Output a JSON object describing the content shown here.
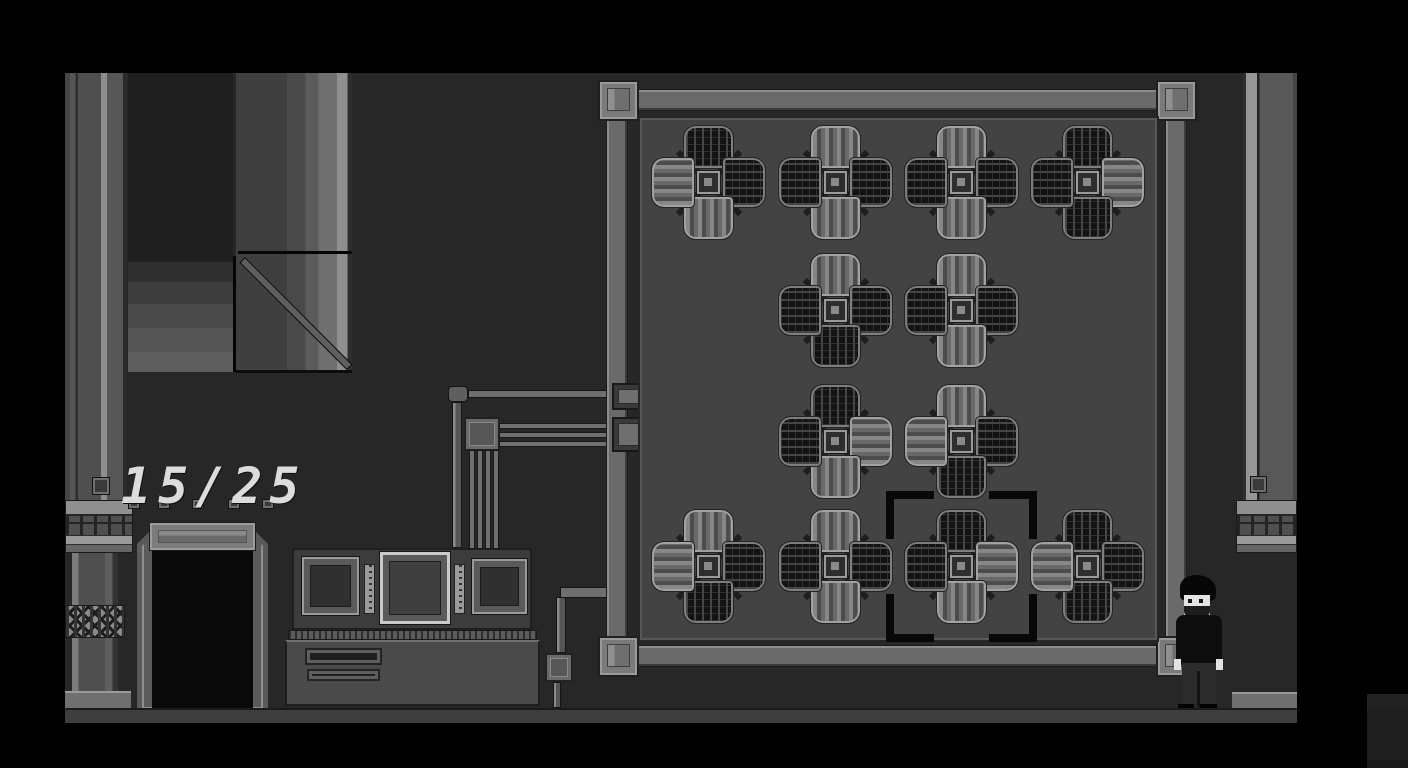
{
  "hud": {
    "counter": "15/25",
    "counter_current": 15,
    "counter_total": 25
  },
  "colors": {
    "wall": "#272727",
    "board": "#434343",
    "floor": "#3e3e3e",
    "tileborder": "#a2a2a2",
    "sel": "#080808",
    "hudtext": "#dcdcdc",
    "skin": "#e3e3e3",
    "shirt": "#0d0d0d"
  },
  "puzzle": {
    "rows": 4,
    "cols": 4,
    "selected": {
      "row": 4,
      "col": 3
    },
    "tiles": [
      {
        "row": 1,
        "col": 1,
        "arms": {
          "top": "dark",
          "right": "dark",
          "bottom": "light",
          "left": "light"
        }
      },
      {
        "row": 1,
        "col": 2,
        "arms": {
          "top": "light",
          "right": "dark",
          "bottom": "light",
          "left": "dark"
        }
      },
      {
        "row": 1,
        "col": 3,
        "arms": {
          "top": "light",
          "right": "dark",
          "bottom": "light",
          "left": "dark"
        }
      },
      {
        "row": 1,
        "col": 4,
        "arms": {
          "top": "dark",
          "right": "light",
          "bottom": "dark",
          "left": "dark"
        }
      },
      {
        "row": 2,
        "col": 2,
        "arms": {
          "top": "light",
          "right": "dark",
          "bottom": "dark",
          "left": "dark"
        }
      },
      {
        "row": 2,
        "col": 3,
        "arms": {
          "top": "light",
          "right": "dark",
          "bottom": "light",
          "left": "dark"
        }
      },
      {
        "row": 3,
        "col": 2,
        "arms": {
          "top": "dark",
          "right": "light",
          "bottom": "light",
          "left": "dark"
        }
      },
      {
        "row": 3,
        "col": 3,
        "arms": {
          "top": "light",
          "right": "dark",
          "bottom": "dark",
          "left": "light"
        }
      },
      {
        "row": 4,
        "col": 1,
        "arms": {
          "top": "light",
          "right": "dark",
          "bottom": "dark",
          "left": "light"
        }
      },
      {
        "row": 4,
        "col": 2,
        "arms": {
          "top": "light",
          "right": "dark",
          "bottom": "light",
          "left": "dark"
        }
      },
      {
        "row": 4,
        "col": 3,
        "arms": {
          "top": "dark",
          "right": "light",
          "bottom": "light",
          "left": "dark"
        }
      },
      {
        "row": 4,
        "col": 4,
        "arms": {
          "top": "dark",
          "right": "dark",
          "bottom": "dark",
          "left": "light"
        }
      }
    ]
  }
}
